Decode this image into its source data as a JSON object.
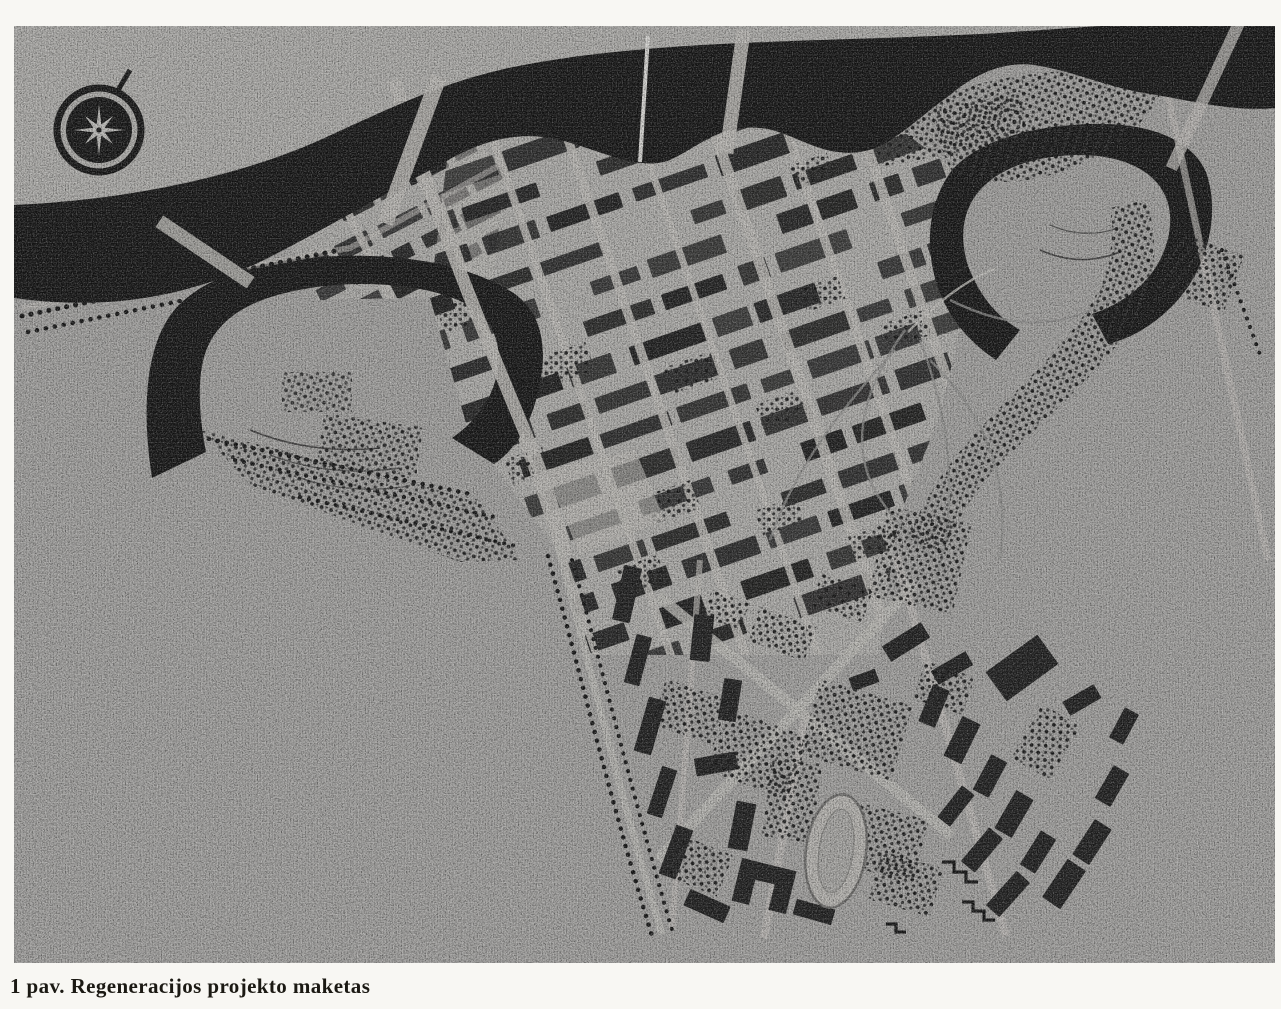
{
  "figure": {
    "caption": "1 pav. Regeneracijos projekto maketas",
    "subject": "aerial photograph of a physical scale model of an old-town regeneration project",
    "compass_icon": "compass-rose-icon"
  },
  "colors": {
    "page": "#f8f7f3",
    "photo": "#a3a2a0",
    "far_bank": "#aeadaa",
    "ink": "#161616",
    "building": "#202020",
    "street": "#bab8b4",
    "caption_text": "#1b1913"
  }
}
